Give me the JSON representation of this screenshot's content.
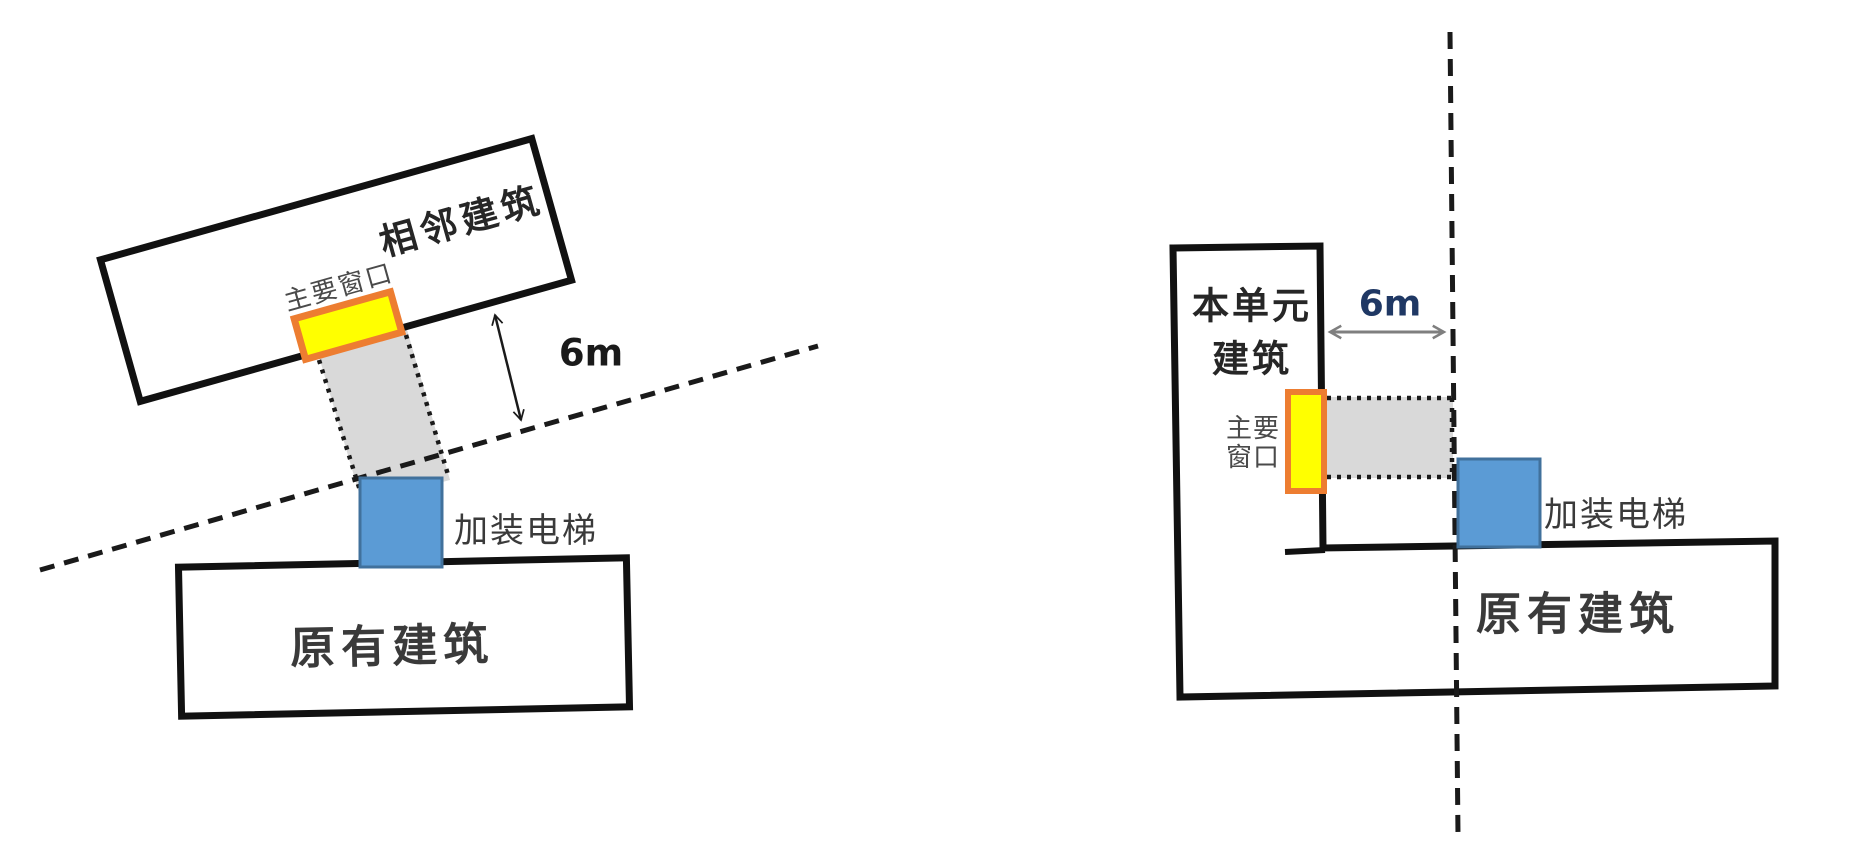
{
  "colors": {
    "outline": "#111111",
    "line_dark": "#1a1a1a",
    "corridor_fill": "#d9d9d9",
    "elevator_fill": "#5b9bd5",
    "elevator_stroke": "#41719c",
    "window_fill": "#ffff00",
    "window_stroke": "#ed7d31",
    "label_dark": "#3a3a3a",
    "label_black": "#262626",
    "label_gray": "#4a4a4a",
    "arrow_gray": "#7f7f7f",
    "distance_left_color": "#1a1a1a",
    "distance_right_color": "#1f3864",
    "white": "#ffffff"
  },
  "left_diagram": {
    "adjacent_building_label": "相邻建筑",
    "main_window_label": "主要窗口",
    "elevator_label": "加装电梯",
    "original_building_label": "原有建筑",
    "distance_label": "6m"
  },
  "right_diagram": {
    "unit_building_label_line1": "本单元",
    "unit_building_label_line2": "建筑",
    "main_window_label_line1": "主要",
    "main_window_label_line2": "窗口",
    "elevator_label": "加装电梯",
    "original_building_label": "原有建筑",
    "distance_label": "6m"
  }
}
